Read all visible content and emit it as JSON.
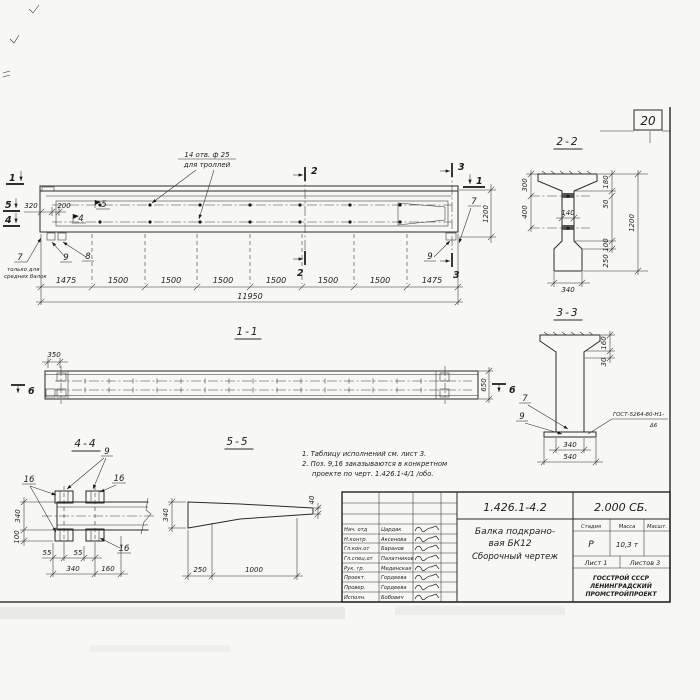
{
  "page": {
    "sheet_number_box": "20"
  },
  "elevation": {
    "holes_note_line1": "14 отв. ф 25",
    "holes_note_line2": "для троллей",
    "dim_320": "320",
    "dim_200": "200",
    "flag_5": "5",
    "flag_4": "4",
    "cut_1": "1",
    "cut_2": "2",
    "cut_3": "3",
    "cut_4": "4",
    "cut_5": "5",
    "pos_7": "7",
    "pos_8": "8",
    "pos_9": "9",
    "only_note_line1": "только для",
    "only_note_line2": "средних балок",
    "dims_bottom": [
      "1475",
      "1500",
      "1500",
      "1500",
      "1500",
      "1500",
      "1500",
      "1475"
    ],
    "dim_total": "11950",
    "dim_height": "1200"
  },
  "section_2_2": {
    "title": "2-2",
    "dim_300": "300",
    "dim_400": "400",
    "dim_140": "140",
    "dim_180": "180",
    "dim_50": "50",
    "dim_1200": "1200",
    "dim_100": "100",
    "dim_250": "250",
    "dim_340": "340"
  },
  "section_3_3": {
    "title": "3-3",
    "dim_160": "160",
    "dim_30": "30",
    "pos_7": "7",
    "pos_9": "9",
    "weld_note_top": "ГОСТ-5264-80-Н1-",
    "weld_note_bottom": "Δ6",
    "dim_340": "340",
    "dim_540": "540"
  },
  "section_1_1": {
    "title": "1-1",
    "dim_350": "350",
    "dim_650": "650",
    "cut_6": "6"
  },
  "section_4_4": {
    "title": "4-4",
    "pos_9": "9",
    "pos_16": "16",
    "dim_340_v": "340",
    "dim_100": "100",
    "dim_55_a": "55",
    "dim_55_b": "55",
    "dim_340_h": "340",
    "dim_160": "160"
  },
  "section_5_5": {
    "title": "5-5",
    "dim_340": "340",
    "dim_40": "40",
    "dim_250": "250",
    "dim_1000": "1000"
  },
  "notes": {
    "line1": "1. Таблицу исполнений см. лист 3.",
    "line2": "2. Поз. 9,16 заказываются в конкретном",
    "line3": "проекте по черт. 1.426.1-4/1 /обо."
  },
  "titleblock": {
    "doc_number": "1.426.1-4.2",
    "doc_set": "2.000 СБ.",
    "title_line1": "Балка подкрано-",
    "title_line2": "вая БК12",
    "title_line3": "Сборочный чертеж",
    "stage_label": "Стадия",
    "mass_label": "Масса",
    "scale_label": "Масшт.",
    "stage_value": "Р",
    "mass_value": "10,3 т",
    "sheet_info": "Лист 1",
    "sheets_info": "Листов 3",
    "org_line1": "ГОССТРОЙ СССР",
    "org_line2": "ЛЕНИНГРАДСКИЙ",
    "org_line3": "ПРОМСТРОЙПРОЕКТ",
    "rows": [
      {
        "role": "Нач. отд",
        "name": "Цардак"
      },
      {
        "role": "Н.контр.",
        "name": "Аксенова"
      },
      {
        "role": "Гл.кон.от",
        "name": "Баранов"
      },
      {
        "role": "Гл.спец.от",
        "name": "Палатников"
      },
      {
        "role": "Рук. гр.",
        "name": "Мединская"
      },
      {
        "role": "Проект.",
        "name": "Гордеева"
      },
      {
        "role": "Провер.",
        "name": "Гордеева"
      },
      {
        "role": "Исполн.",
        "name": "Бобович"
      }
    ]
  }
}
